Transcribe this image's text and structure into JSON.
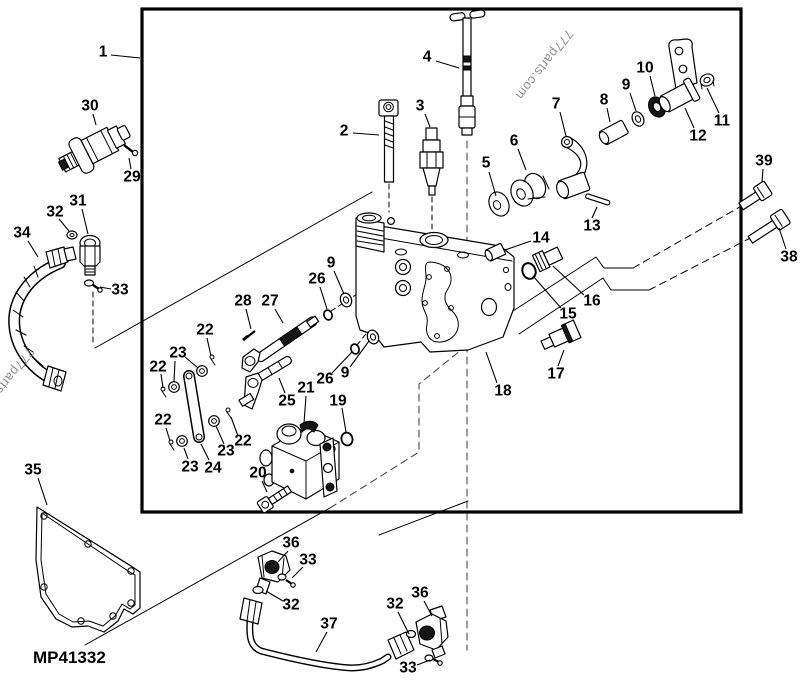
{
  "figure": {
    "part_code": "MP41332",
    "watermark_text": "777parts.com",
    "colors": {
      "ink": "#000000",
      "watermark": "#8f8f8f",
      "construction": "#4a4a4a",
      "background": "#ffffff"
    },
    "part_code_pos": {
      "x": 33,
      "y": 663
    },
    "watermarks": [
      {
        "x": 541,
        "y": 62,
        "rotate": 128
      },
      {
        "x": 28,
        "y": 347,
        "rotate": 128
      }
    ]
  },
  "callouts": [
    {
      "label": "1",
      "x": 103,
      "y": 52,
      "leaders": [
        [
          111,
          55,
          140,
          58
        ]
      ]
    },
    {
      "label": "2",
      "x": 344,
      "y": 131,
      "leaders": [
        [
          353,
          133,
          379,
          135
        ]
      ]
    },
    {
      "label": "3",
      "x": 420,
      "y": 106,
      "leaders": [
        [
          425,
          114,
          430,
          127
        ]
      ]
    },
    {
      "label": "4",
      "x": 427,
      "y": 57,
      "leaders": [
        [
          436,
          61,
          459,
          68
        ]
      ]
    },
    {
      "label": "5",
      "x": 486,
      "y": 163,
      "leaders": [
        [
          489,
          172,
          496,
          196
        ]
      ]
    },
    {
      "label": "6",
      "x": 514,
      "y": 141,
      "leaders": [
        [
          518,
          149,
          526,
          170
        ]
      ]
    },
    {
      "label": "7",
      "x": 556,
      "y": 104,
      "leaders": [
        [
          560,
          112,
          566,
          136
        ]
      ]
    },
    {
      "label": "8",
      "x": 604,
      "y": 100,
      "leaders": [
        [
          607,
          108,
          610,
          122
        ]
      ]
    },
    {
      "label": "9",
      "x": 626,
      "y": 85,
      "leaders": [
        [
          630,
          93,
          636,
          111
        ]
      ]
    },
    {
      "label": "10",
      "x": 645,
      "y": 68,
      "leaders": [
        [
          650,
          76,
          655,
          96
        ]
      ]
    },
    {
      "label": "11",
      "x": 722,
      "y": 121,
      "leaders": [
        [
          719,
          113,
          707,
          88
        ]
      ]
    },
    {
      "label": "12",
      "x": 698,
      "y": 136,
      "leaders": [
        [
          694,
          128,
          685,
          108
        ]
      ]
    },
    {
      "label": "13",
      "x": 592,
      "y": 226,
      "leaders": [
        [
          592,
          218,
          597,
          207
        ]
      ]
    },
    {
      "label": "14",
      "x": 541,
      "y": 238,
      "leaders": [
        [
          531,
          241,
          505,
          250
        ]
      ]
    },
    {
      "label": "15",
      "x": 568,
      "y": 314,
      "leaders": [
        [
          561,
          308,
          533,
          276
        ]
      ]
    },
    {
      "label": "16",
      "x": 592,
      "y": 301,
      "leaders": [
        [
          584,
          295,
          553,
          266
        ]
      ]
    },
    {
      "label": "17",
      "x": 556,
      "y": 374,
      "leaders": [
        [
          558,
          366,
          564,
          350
        ]
      ]
    },
    {
      "label": "18",
      "x": 503,
      "y": 391,
      "leaders": [
        [
          497,
          383,
          486,
          352
        ]
      ]
    },
    {
      "label": "19",
      "x": 338,
      "y": 401,
      "leaders": [
        [
          342,
          408,
          346,
          432
        ]
      ]
    },
    {
      "label": "20",
      "x": 258,
      "y": 473,
      "leaders": [
        [
          262,
          481,
          267,
          492
        ]
      ]
    },
    {
      "label": "21",
      "x": 306,
      "y": 388,
      "leaders": [
        [
          306,
          396,
          304,
          423
        ]
      ]
    },
    {
      "label": "22",
      "x": 205,
      "y": 330,
      "leaders": [
        [
          207,
          338,
          211,
          356
        ]
      ]
    },
    {
      "label": "22",
      "x": 158,
      "y": 367,
      "leaders": [
        [
          161,
          374,
          163,
          388
        ]
      ]
    },
    {
      "label": "22",
      "x": 163,
      "y": 420,
      "leaders": [
        [
          166,
          428,
          170,
          441
        ]
      ]
    },
    {
      "label": "22",
      "x": 243,
      "y": 441,
      "leaders": [
        [
          238,
          436,
          231,
          417
        ]
      ]
    },
    {
      "label": "23",
      "x": 178,
      "y": 353,
      "leaders": [
        [
          185,
          357,
          198,
          368
        ],
        [
          175,
          361,
          174,
          382
        ]
      ]
    },
    {
      "label": "23",
      "x": 226,
      "y": 451,
      "leaders": [
        [
          224,
          444,
          216,
          426
        ]
      ]
    },
    {
      "label": "23",
      "x": 190,
      "y": 467,
      "leaders": [
        [
          188,
          459,
          184,
          448
        ]
      ]
    },
    {
      "label": "24",
      "x": 213,
      "y": 468,
      "leaders": [
        [
          209,
          460,
          201,
          444
        ]
      ]
    },
    {
      "label": "25",
      "x": 287,
      "y": 401,
      "leaders": [
        [
          285,
          393,
          279,
          378
        ]
      ]
    },
    {
      "label": "26",
      "x": 317,
      "y": 279,
      "leaders": [
        [
          320,
          287,
          327,
          309
        ]
      ]
    },
    {
      "label": "26",
      "x": 325,
      "y": 379,
      "leaders": [
        [
          332,
          373,
          352,
          352
        ]
      ]
    },
    {
      "label": "27",
      "x": 270,
      "y": 301,
      "leaders": [
        [
          275,
          309,
          283,
          323
        ]
      ]
    },
    {
      "label": "28",
      "x": 243,
      "y": 301,
      "leaders": [
        [
          246,
          309,
          251,
          329
        ]
      ]
    },
    {
      "label": "9",
      "x": 331,
      "y": 263,
      "leaders": [
        [
          334,
          271,
          344,
          294
        ]
      ]
    },
    {
      "label": "9",
      "x": 345,
      "y": 373,
      "leaders": [
        [
          350,
          367,
          369,
          341
        ]
      ]
    },
    {
      "label": "29",
      "x": 132,
      "y": 177,
      "leaders": [
        [
          131,
          169,
          129,
          158
        ]
      ]
    },
    {
      "label": "30",
      "x": 90,
      "y": 106,
      "leaders": [
        [
          93,
          114,
          96,
          125
        ]
      ]
    },
    {
      "label": "31",
      "x": 78,
      "y": 201,
      "leaders": [
        [
          82,
          209,
          88,
          234
        ]
      ]
    },
    {
      "label": "32",
      "x": 55,
      "y": 212,
      "leaders": [
        [
          59,
          219,
          69,
          231
        ]
      ]
    },
    {
      "label": "33",
      "x": 120,
      "y": 290,
      "leaders": [
        [
          111,
          289,
          100,
          287
        ]
      ]
    },
    {
      "label": "34",
      "x": 22,
      "y": 233,
      "leaders": [
        [
          28,
          241,
          38,
          257
        ]
      ]
    },
    {
      "label": "35",
      "x": 33,
      "y": 470,
      "leaders": [
        [
          38,
          478,
          47,
          505
        ]
      ]
    },
    {
      "label": "36",
      "x": 291,
      "y": 543,
      "leaders": [
        [
          288,
          551,
          278,
          562
        ]
      ]
    },
    {
      "label": "33",
      "x": 308,
      "y": 560,
      "leaders": [
        [
          303,
          567,
          292,
          578
        ]
      ]
    },
    {
      "label": "32",
      "x": 291,
      "y": 605,
      "leaders": [
        [
          283,
          601,
          266,
          591
        ]
      ]
    },
    {
      "label": "37",
      "x": 329,
      "y": 624,
      "leaders": [
        [
          327,
          632,
          316,
          652
        ]
      ]
    },
    {
      "label": "32",
      "x": 395,
      "y": 604,
      "leaders": [
        [
          398,
          612,
          409,
          634
        ]
      ]
    },
    {
      "label": "36",
      "x": 420,
      "y": 593,
      "leaders": [
        [
          424,
          601,
          432,
          616
        ]
      ]
    },
    {
      "label": "33",
      "x": 408,
      "y": 668,
      "leaders": [
        [
          417,
          665,
          430,
          660
        ]
      ]
    },
    {
      "label": "38",
      "x": 789,
      "y": 257,
      "leaders": [
        [
          786,
          249,
          779,
          228
        ]
      ]
    },
    {
      "label": "39",
      "x": 764,
      "y": 161,
      "leaders": [
        [
          763,
          169,
          762,
          182
        ]
      ]
    }
  ]
}
